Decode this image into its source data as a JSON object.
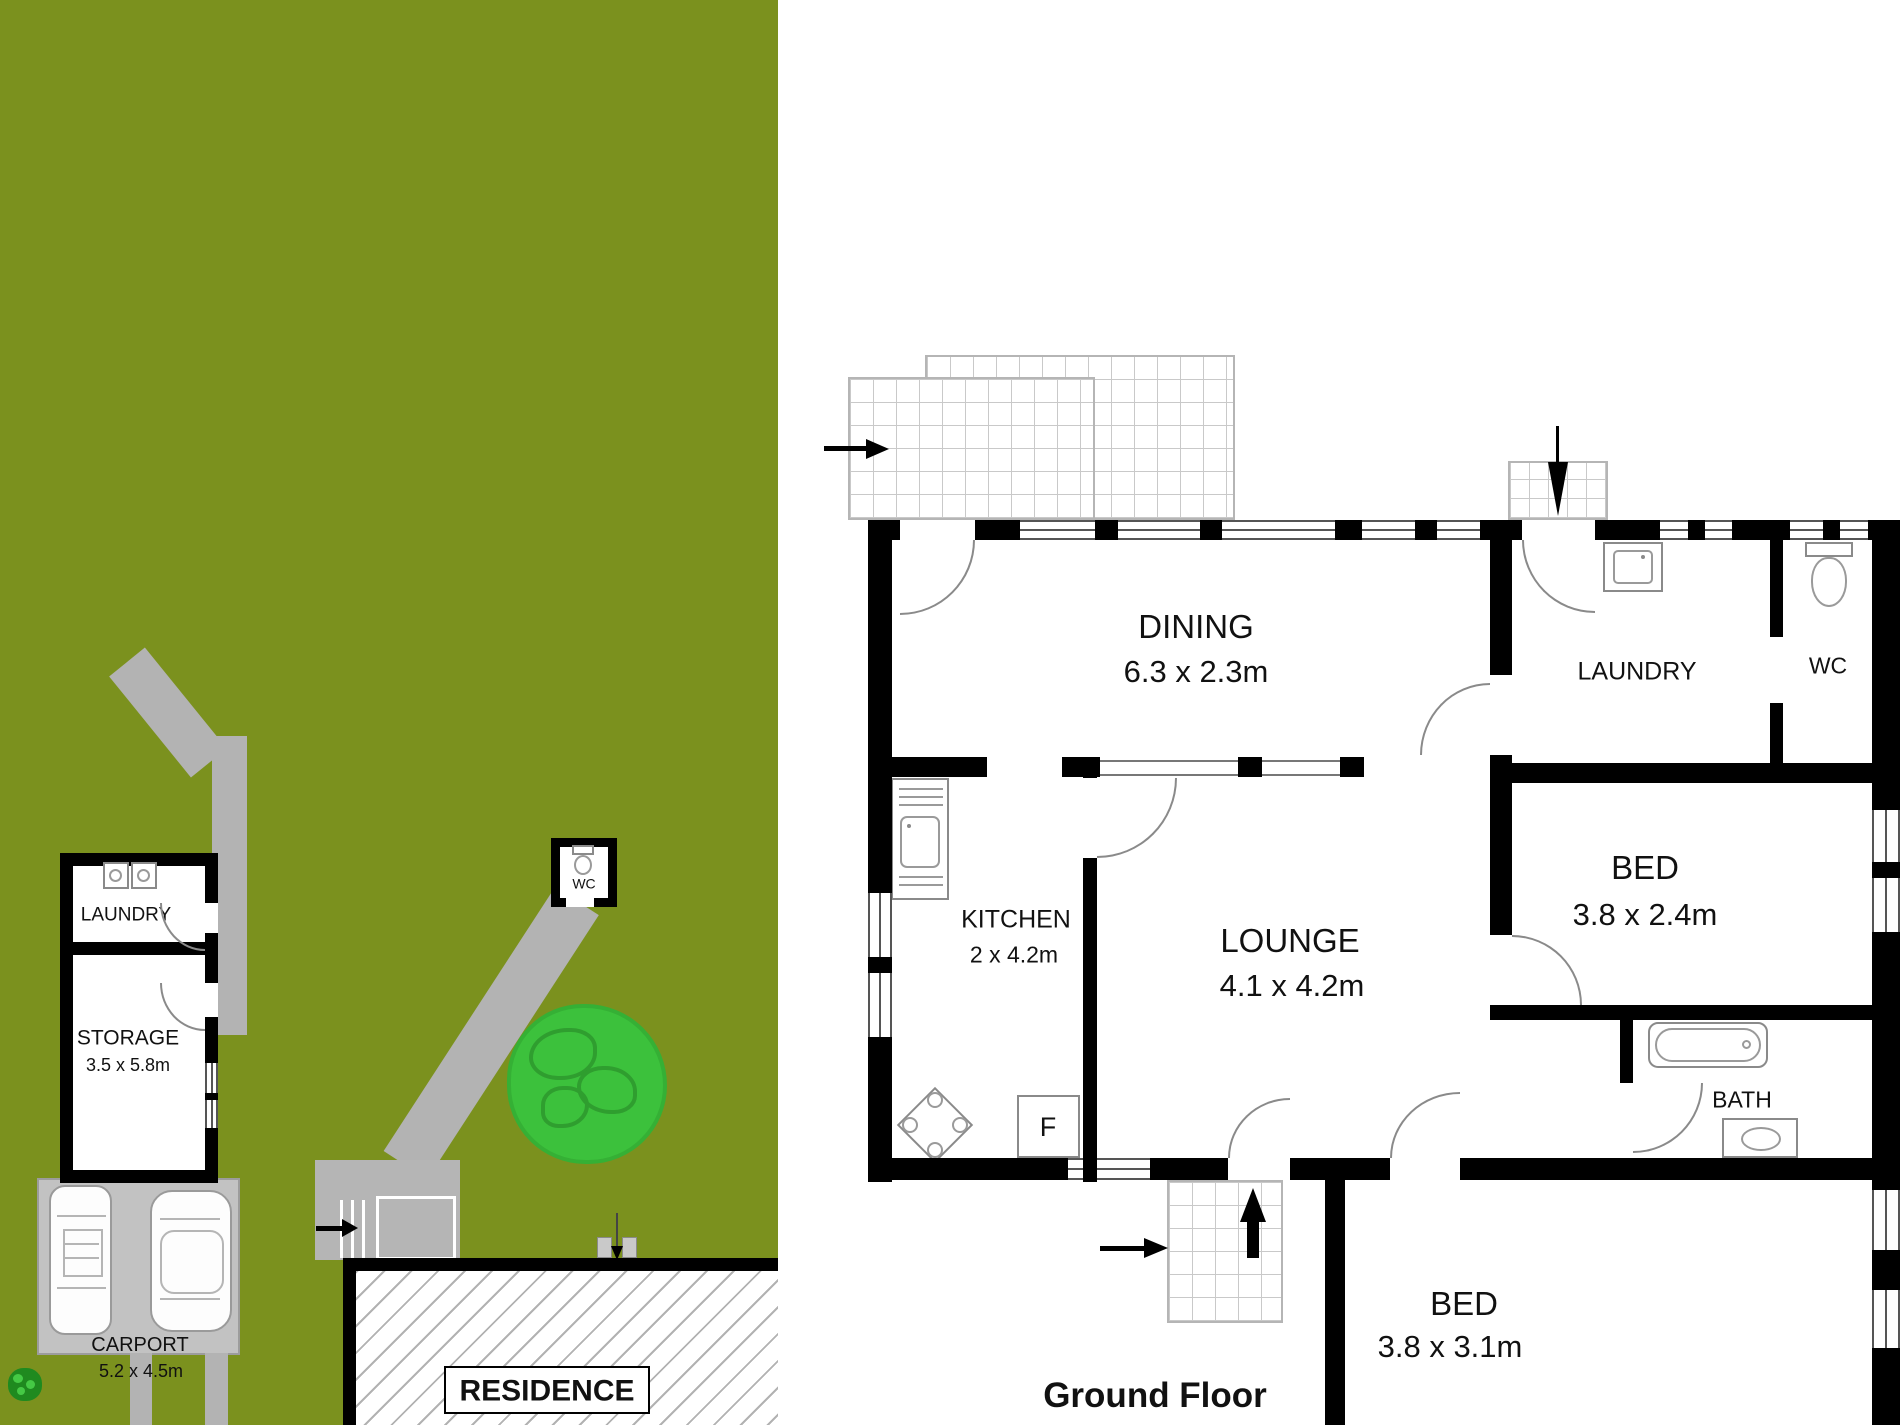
{
  "site_plan": {
    "outbuilding": {
      "laundry_label": "LAUNDRY",
      "storage_label": "STORAGE",
      "storage_dims": "3.5 x 5.8m"
    },
    "carport": {
      "label": "CARPORT",
      "dims": "5.2 x 4.5m"
    },
    "wc_hut": {
      "label": "WC"
    },
    "residence": {
      "label": "RESIDENCE"
    }
  },
  "floor_plan": {
    "title": "Ground Floor",
    "fridge_label": "F",
    "rooms": {
      "dining": {
        "label": "DINING",
        "dims": "6.3 x 2.3m"
      },
      "kitchen": {
        "label": "KITCHEN",
        "dims": "2 x 4.2m"
      },
      "lounge": {
        "label": "LOUNGE",
        "dims": "4.1 x 4.2m"
      },
      "laundry": {
        "label": "LAUNDRY"
      },
      "wc": {
        "label": "WC"
      },
      "bed1": {
        "label": "BED",
        "dims": "3.8 x 2.4m"
      },
      "bath": {
        "label": "BATH"
      },
      "bed2": {
        "label": "BED",
        "dims": "3.8 x 3.1m"
      }
    }
  },
  "colors": {
    "grass": "#7b911e",
    "path_gray": "#b3b3b3",
    "carport_gray": "#c2c2c2",
    "tree_green": "#3cc13c",
    "tree_line_green": "#2f9e2f",
    "wall_black": "#000000"
  }
}
